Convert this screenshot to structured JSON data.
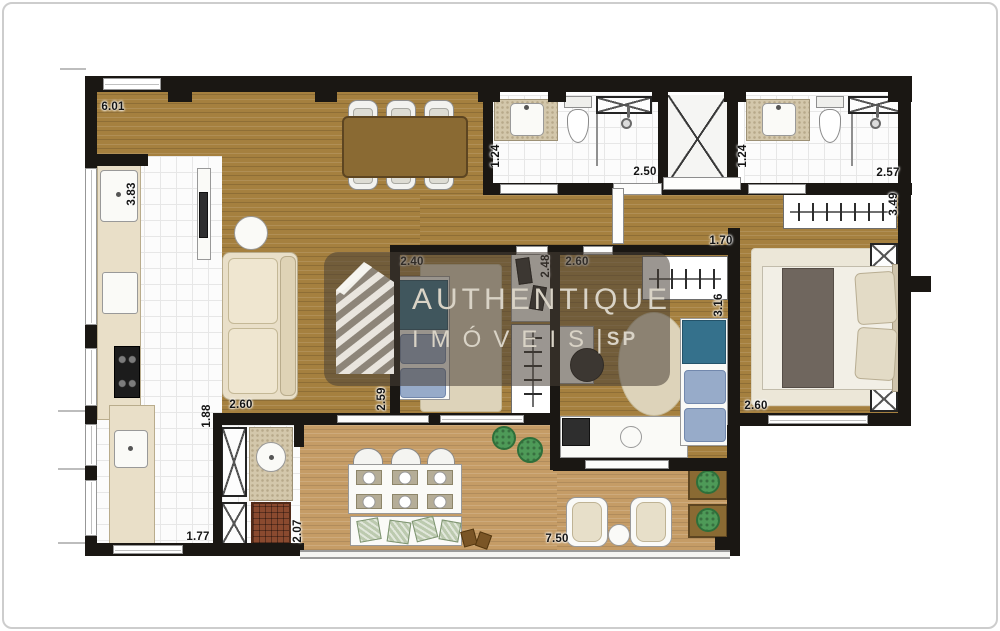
{
  "watermark": {
    "line1": "AUTHENTIQUE",
    "line2": "IMÓVEIS",
    "separator": "|",
    "line3": "SP",
    "text_color": "#d9d3c6",
    "panel_color": "rgba(72,64,55,0.55)"
  },
  "measurements": {
    "living_top": "6.01",
    "kitchen_left": "3.83",
    "bath1_width": "1.24",
    "bath1_length": "2.50",
    "bath2_width": "1.24",
    "bath2_length": "2.57",
    "master_closet": "3.49",
    "bed2_closet": "1.70",
    "bed1_width": "2.40",
    "bed1_closet": "2.48",
    "bed2_width": "2.60",
    "bed2_height": "3.16",
    "bed1_height": "2.59",
    "living_sofa": "2.60",
    "master_width": "2.60",
    "kitchen_passage": "1.88",
    "kitchen_bottom": "1.77",
    "service_height": "2.07",
    "balcony_width": "7.50"
  },
  "palette": {
    "wall": "#1a1713",
    "wood_floor": "#a5803f",
    "deck_floor": "#c59c66",
    "accent_teal": "#35718c",
    "accent_blue": "#97abc9",
    "plant_green": "#4e9a58",
    "grill_brick": "#8a4a2f"
  }
}
